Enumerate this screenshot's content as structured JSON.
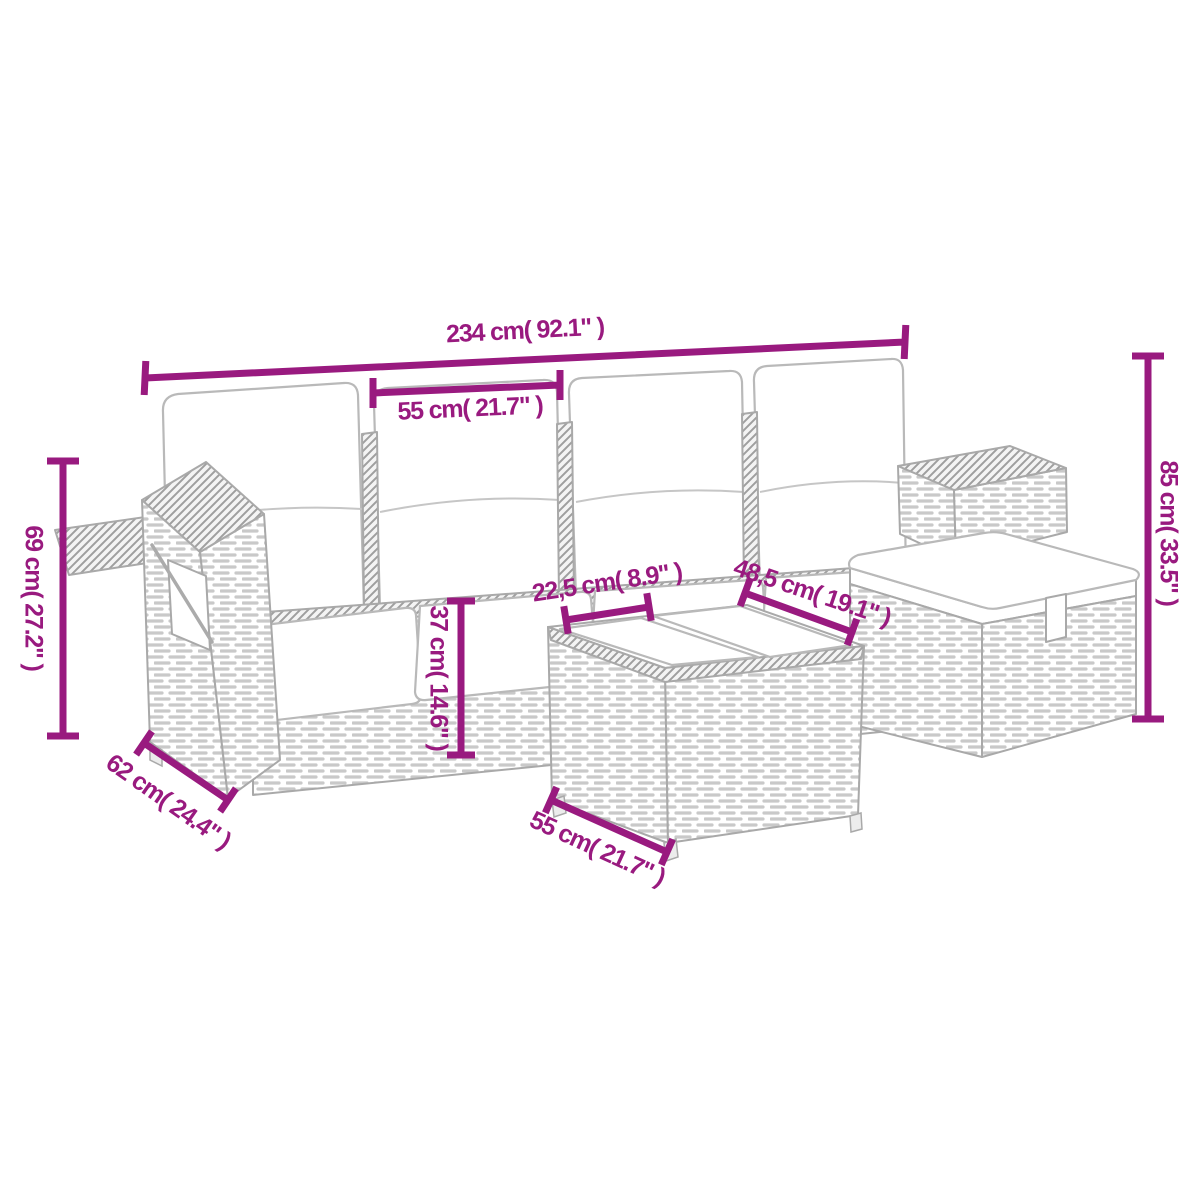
{
  "colors": {
    "accent": "#991a7f",
    "line_art": "#a9a9a9",
    "background": "#ffffff"
  },
  "diagram": {
    "measurements": {
      "top_total": "234 cm( 92.1\" )",
      "backrest_cushion": "55 cm( 21.7\" )",
      "right_height": "85 cm( 33.5\" )",
      "left_height": "69 cm( 27.2\" )",
      "seat_front_depth": "22,5 cm( 8.9\" )",
      "corner_tray": "48,5 cm( 19.1\" )",
      "base_height": "37 cm( 14.6\" )",
      "side_depth": "62 cm( 24.4\" )",
      "table_side": "55 cm( 21.7\" )"
    }
  }
}
